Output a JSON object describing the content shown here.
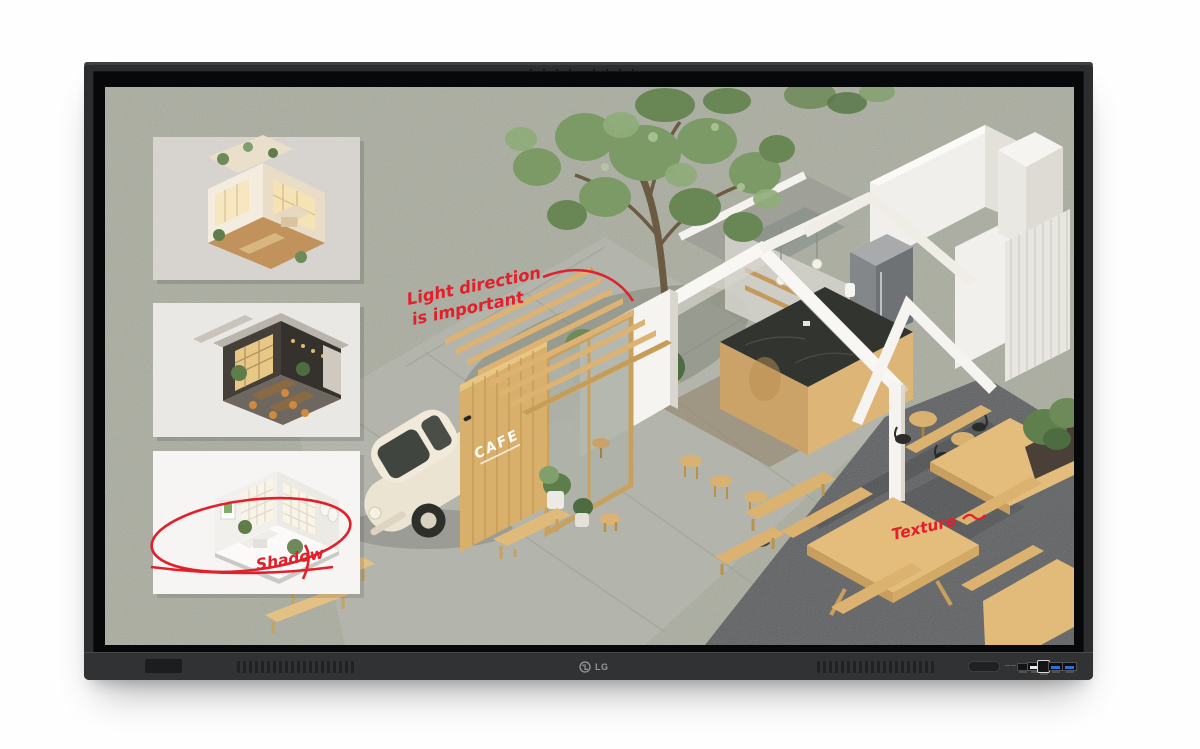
{
  "device": {
    "brand": "LG",
    "logo_text": "LG",
    "bezel_color": "#2b2d2f",
    "ports": [
      {
        "name": "power-button"
      },
      {
        "name": "hdmi-port"
      },
      {
        "name": "usb-a-port"
      },
      {
        "name": "usb-b-port"
      },
      {
        "name": "usb3-port-1"
      },
      {
        "name": "usb3-port-2"
      }
    ]
  },
  "screen": {
    "background_color": "#a9ac9e",
    "annotations": {
      "ink_color": "#e2202c",
      "light_direction_line1": "Light direction",
      "light_direction_line2": "is important",
      "shadow_label": "Shadow",
      "texture_label": "Texture"
    },
    "main_render": {
      "cafe_sign_text": "CAFE"
    },
    "thumbnails": [
      {
        "name": "warm-cafe-interior-cutaway"
      },
      {
        "name": "dark-lounge-interior-cutaway"
      },
      {
        "name": "white-room-interior-cutaway"
      }
    ]
  }
}
